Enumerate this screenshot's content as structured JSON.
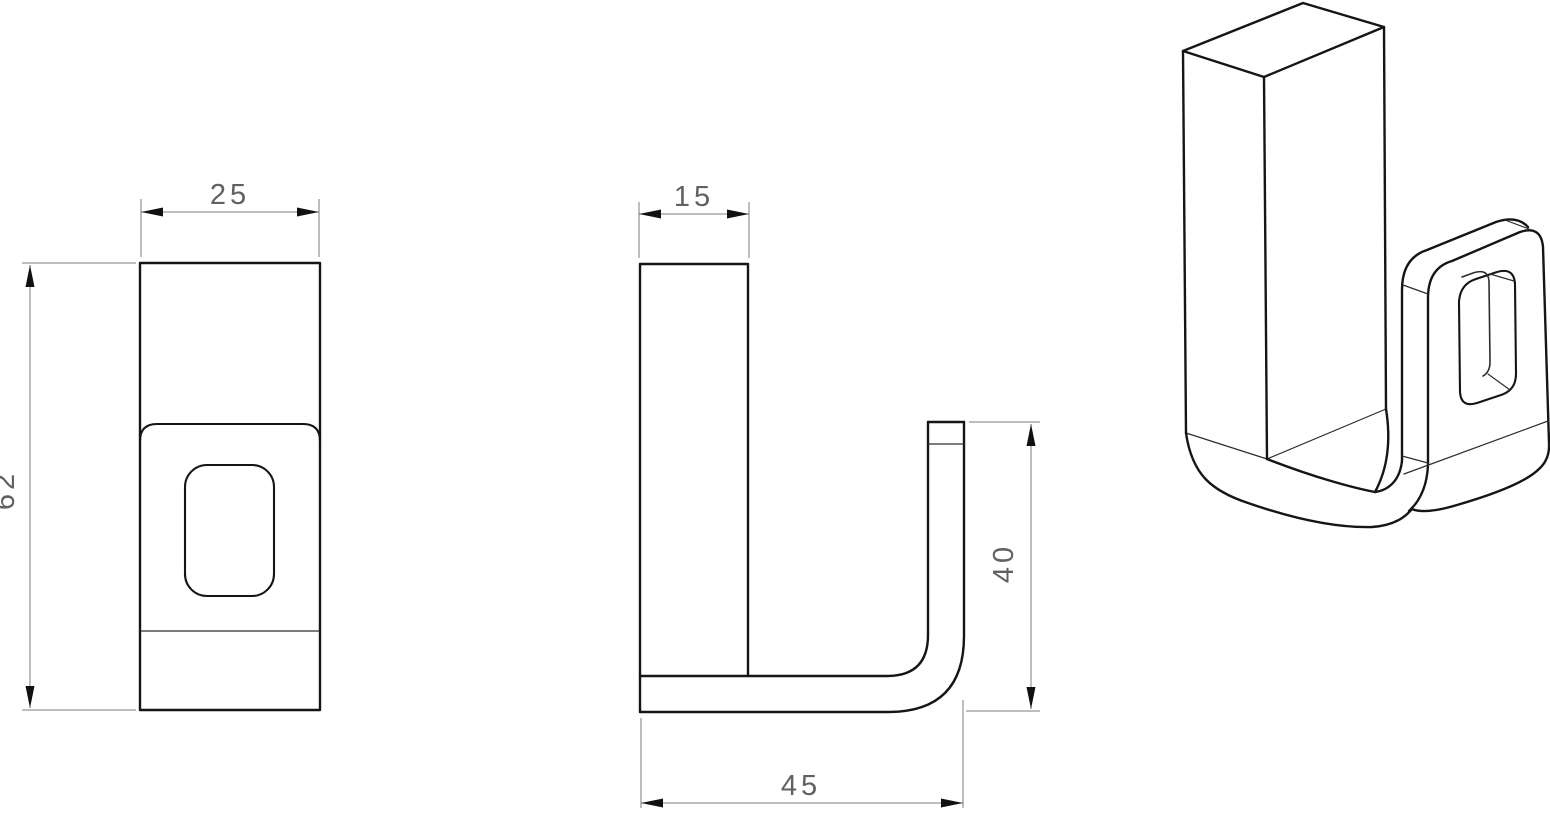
{
  "drawing": {
    "type": "technical-orthographic-drawing",
    "part": "j-hook-bracket",
    "views": {
      "front": {
        "width_label": "25",
        "height_label": "62"
      },
      "side": {
        "wall_depth_label": "15",
        "hook_height_label": "40",
        "total_depth_label": "45"
      },
      "isometric": {}
    },
    "colors": {
      "outline": "#151515",
      "dimension_lines": "#7d7d7d",
      "dimension_text": "#616161",
      "arrowheads": "#111111",
      "background": "#ffffff"
    }
  }
}
